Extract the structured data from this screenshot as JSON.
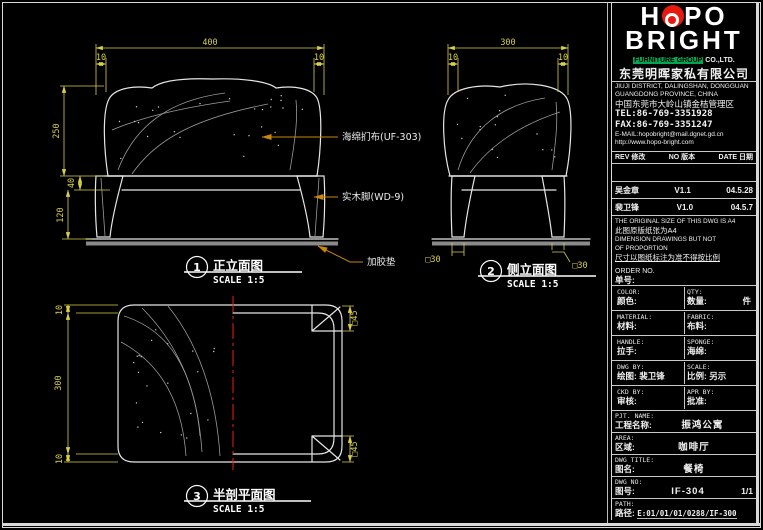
{
  "colors": {
    "background": "#000000",
    "line": "#e6e6e6",
    "dimension": "#d8cf45",
    "leader": "#c8860a",
    "logo_red": "#e8190f",
    "highlight_green": "#00a651",
    "centerline_red": "#ee2211"
  },
  "logo": {
    "h": "H",
    "p_o": "PO",
    "bright": "BRIGHT",
    "group_hl": "FURNITURE GROUP",
    "group_rest": "CO.,LTD.",
    "company": "东莞明晖家私有限公司"
  },
  "address": {
    "en1": "JIUJI DISTRICT, DALINGSHAN, DONGGUAN",
    "en2": "GUANGDONG PROVINCE, CHINA",
    "cn": "中国东莞市大岭山镇金桔管理区",
    "tel": "TEL:86-769-3351928",
    "fax": "FAX:86-769-3351247",
    "email": "E-MAIL:hopobright@mail.dgnet.gd.cn",
    "web": "http://www.hopo-bright.com"
  },
  "rev": {
    "h_rev": "REV 修改",
    "h_no": "NO 版本",
    "h_date": "DATE 日期",
    "r1_name": "吴金章",
    "r1_ver": "V1.1",
    "r1_date": "04.5.28",
    "r2_name": "裴卫锋",
    "r2_ver": "V1.0",
    "r2_date": "04.5.7"
  },
  "notes": {
    "l1": "THE ORIGINAL SIZE OF THIS DWG IS A4",
    "l2": "此图原版纸张为A4",
    "l3": "DIMENSION DRAWINGS BUT NOT",
    "l4": "OF PROPORTION",
    "l5": "尺寸以图纸标注为准不得按比例"
  },
  "order": {
    "en": "ORDER NO.",
    "cn": "单号:"
  },
  "fields": {
    "color_en": "COLOR:",
    "color_cn": "颜色:",
    "qty_en": "QTY:",
    "qty_cn": "数量:",
    "qty_unit": "件",
    "material_en": "MATERIAL:",
    "material_cn": "材料:",
    "fabric_en": "FABRIC:",
    "fabric_cn": "布料:",
    "handle_en": "HANDLE:",
    "handle_cn": "拉手:",
    "sponge_en": "SPONGE:",
    "sponge_cn": "海绵:",
    "dwgby_en": "DWG BY:",
    "dwgby_cn": "绘图:",
    "dwgby_val": "裴卫锋",
    "scale_en": "SCALE:",
    "scale_cn": "比例:",
    "scale_val": "另示",
    "ckd_en": "CKD BY:",
    "ckd_cn": "审核:",
    "apr_en": "APR BY:",
    "apr_cn": "批准:",
    "pjt_en": "PJT. NAME:",
    "pjt_cn": "工程名称:",
    "pjt_val": "振鸿公寓",
    "area_en": "AREA:",
    "area_cn": "区域:",
    "area_val": "咖啡厅",
    "title_en": "DWG TITLE:",
    "title_cn": "图名:",
    "title_val": "餐椅",
    "no_en": "DWG NO:",
    "no_cn": "图号:",
    "no_val": "IF-304",
    "no_page": "1/1",
    "path_en": "PATH:",
    "path_cn": "路径:",
    "path_val": "E:01/01/01/0288/IF-300"
  },
  "views": {
    "front": {
      "num": "1",
      "title": "正立面图",
      "scale": "SCALE 1:5",
      "dim_width": "400",
      "dim_m1": "10",
      "dim_m2": "10",
      "dim_h": "250",
      "dim_seat": "40",
      "dim_leg": "120"
    },
    "side": {
      "num": "2",
      "title": "侧立面图",
      "scale": "SCALE 1:5",
      "dim_depth": "300",
      "dim_m1": "10",
      "dim_m2": "10",
      "leg_l": "□30",
      "leg_r": "□30"
    },
    "plan": {
      "num": "3",
      "title": "半剖平面图",
      "scale": "SCALE 1:5",
      "dim_t": "10",
      "dim_depth": "300",
      "dim_b": "10",
      "corner_t": "□45",
      "corner_b": "□45"
    }
  },
  "ann": {
    "fabric": "海绵扪布(UF-303)",
    "leg": "实木脚(WD-9)",
    "pad": "加胶垫"
  }
}
